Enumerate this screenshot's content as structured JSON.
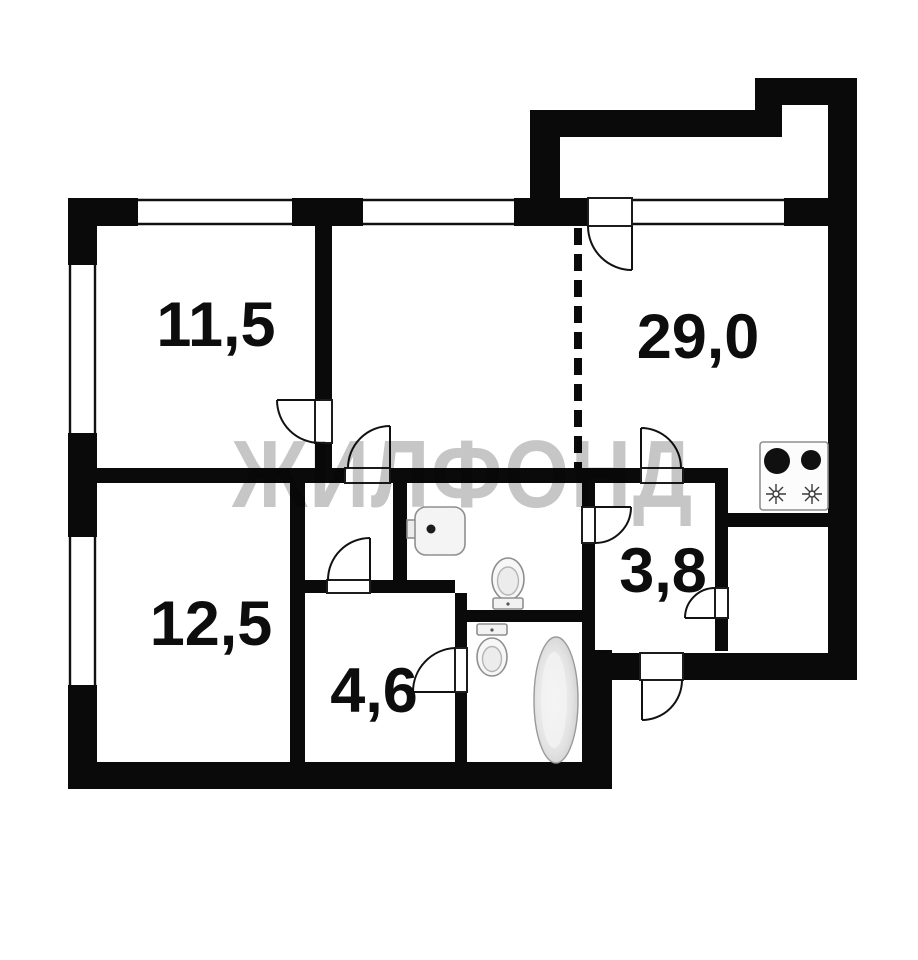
{
  "watermark": {
    "text": "ЖИЛФОНД",
    "color": "#c6c6c6"
  },
  "plan": {
    "type": "apartment-floor-plan",
    "wall_color": "#0a0a0a",
    "floor_color": "#ffffff",
    "room_labels": [
      {
        "name": "room-top-left",
        "label": "11,5"
      },
      {
        "name": "room-right-kitchen-living",
        "label": "29,0"
      },
      {
        "name": "room-bottom-left",
        "label": "12,5"
      },
      {
        "name": "room-small-hall",
        "label": "4,6"
      },
      {
        "name": "corridor",
        "label": "3,8"
      }
    ],
    "fixtures": [
      "stove-two-burners",
      "washbasin",
      "toilet-wc",
      "toilet-bathroom",
      "bathtub"
    ]
  }
}
